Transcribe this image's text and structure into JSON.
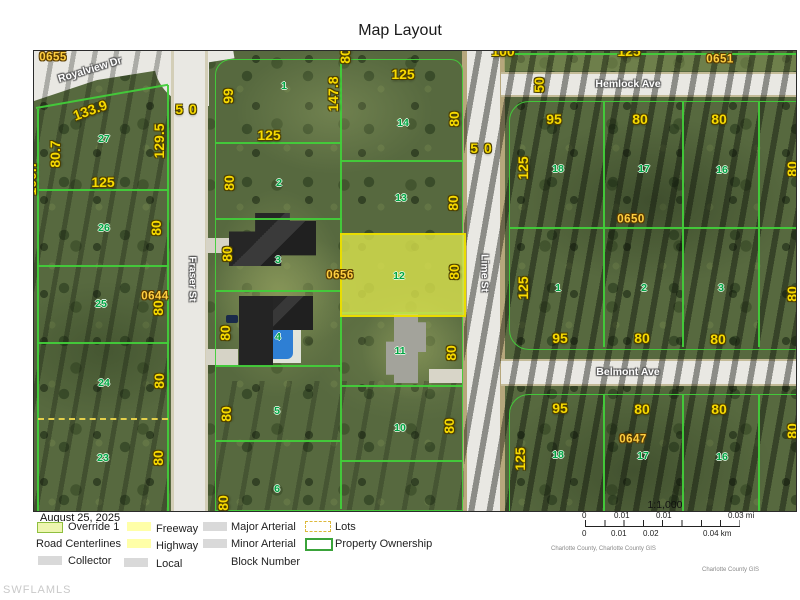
{
  "title": "Map Layout",
  "watermark": "SWFLAMLS",
  "date": "August 25, 2025",
  "colors": {
    "parcel_line_green": "#42ce3a",
    "override_fill_yellow": "#dbe44e",
    "dimension_yellow": "#f8da00",
    "lot_number_green": "#00a445",
    "block_number_yellow": "#ffcf40",
    "street_white": "#e9e8e3"
  },
  "legend": {
    "override": "Override 1",
    "road_centerlines": "Road Centerlines",
    "collector": "Collector",
    "freeway": "Freeway",
    "highway": "Highway",
    "local": "Local",
    "major_arterial": "Major Arterial",
    "minor_arterial": "Minor Arterial",
    "block_number": "Block Number",
    "lots": "Lots",
    "property_ownership": "Property Ownership"
  },
  "scalebar": {
    "ratio": "1:1,000",
    "mi_labels": [
      "0",
      "0.01",
      "0.01",
      "0.03 mi"
    ],
    "km_labels": [
      "0",
      "0.01",
      "0.02",
      "0.04 km"
    ],
    "credit1": "Charlotte County, Charlotte County GIS",
    "credit2": "Charlotte County GIS"
  },
  "map": {
    "streets": [
      "Royalview Dr",
      "Fraser St",
      "Lime St",
      "Hemlock Ave",
      "Belmont Ave"
    ],
    "block_numbers": [
      "0655",
      "0651",
      "0644",
      "0656",
      "0650",
      "0647"
    ],
    "labels": [
      {
        "t": "Royalview Dr",
        "x": 56,
        "y": 19,
        "r": -17,
        "c": "st"
      },
      {
        "t": "Hemlock Ave",
        "x": 594,
        "y": 33,
        "c": "st"
      },
      {
        "t": "Belmont Ave",
        "x": 594,
        "y": 321,
        "c": "st"
      },
      {
        "t": "Fraser St",
        "x": 158,
        "y": 228,
        "r": 90,
        "c": "st"
      },
      {
        "t": "Lime St",
        "x": 450,
        "y": 222,
        "r": 90,
        "c": "st"
      },
      {
        "t": "0655",
        "x": 19,
        "y": 7,
        "c": "blk"
      },
      {
        "t": "0651",
        "x": 686,
        "y": 9,
        "c": "blk"
      },
      {
        "t": "0644",
        "x": 121,
        "y": 246,
        "c": "blk"
      },
      {
        "t": "0656",
        "x": 306,
        "y": 225,
        "c": "blk"
      },
      {
        "t": "0650",
        "x": 597,
        "y": 169,
        "c": "blk"
      },
      {
        "t": "0647",
        "x": 599,
        "y": 389,
        "c": "blk"
      },
      {
        "t": "27",
        "x": 70,
        "y": 88,
        "c": "lot"
      },
      {
        "t": "26",
        "x": 70,
        "y": 177,
        "c": "lot"
      },
      {
        "t": "25",
        "x": 67,
        "y": 253,
        "c": "lot"
      },
      {
        "t": "24",
        "x": 70,
        "y": 332,
        "c": "lot"
      },
      {
        "t": "23",
        "x": 69,
        "y": 407,
        "c": "lot"
      },
      {
        "t": "1",
        "x": 250,
        "y": 35,
        "c": "lot"
      },
      {
        "t": "2",
        "x": 245,
        "y": 132,
        "c": "lot"
      },
      {
        "t": "3",
        "x": 244,
        "y": 209,
        "c": "lot"
      },
      {
        "t": "4",
        "x": 244,
        "y": 286,
        "c": "lot"
      },
      {
        "t": "5",
        "x": 243,
        "y": 360,
        "c": "lot"
      },
      {
        "t": "6",
        "x": 243,
        "y": 438,
        "c": "lot"
      },
      {
        "t": "14",
        "x": 369,
        "y": 72,
        "c": "lot"
      },
      {
        "t": "13",
        "x": 367,
        "y": 147,
        "c": "lot"
      },
      {
        "t": "12",
        "x": 365,
        "y": 225,
        "c": "lot"
      },
      {
        "t": "11",
        "x": 366,
        "y": 300,
        "c": "lot"
      },
      {
        "t": "10",
        "x": 366,
        "y": 377,
        "c": "lot"
      },
      {
        "t": "18",
        "x": 524,
        "y": 118,
        "c": "lot"
      },
      {
        "t": "17",
        "x": 610,
        "y": 118,
        "c": "lot"
      },
      {
        "t": "16",
        "x": 688,
        "y": 119,
        "c": "lot"
      },
      {
        "t": "1",
        "x": 524,
        "y": 237,
        "c": "lot"
      },
      {
        "t": "2",
        "x": 610,
        "y": 237,
        "c": "lot"
      },
      {
        "t": "3",
        "x": 687,
        "y": 237,
        "c": "lot"
      },
      {
        "t": "18",
        "x": 524,
        "y": 404,
        "c": "lot"
      },
      {
        "t": "17",
        "x": 609,
        "y": 405,
        "c": "lot"
      },
      {
        "t": "16",
        "x": 688,
        "y": 406,
        "c": "lot"
      },
      {
        "t": "133.9",
        "x": 56,
        "y": 59,
        "r": -20,
        "c": "dim"
      },
      {
        "t": "125",
        "x": 69,
        "y": 131,
        "c": "dim"
      },
      {
        "t": "125",
        "x": 235,
        "y": 84,
        "c": "dim"
      },
      {
        "t": "125",
        "x": 369,
        "y": 23,
        "c": "dim"
      },
      {
        "t": "95",
        "x": 520,
        "y": 68,
        "c": "dim"
      },
      {
        "t": "80",
        "x": 606,
        "y": 68,
        "c": "dim"
      },
      {
        "t": "80",
        "x": 685,
        "y": 68,
        "c": "dim"
      },
      {
        "t": "95",
        "x": 526,
        "y": 287,
        "c": "dim"
      },
      {
        "t": "80",
        "x": 608,
        "y": 287,
        "c": "dim"
      },
      {
        "t": "80",
        "x": 684,
        "y": 288,
        "c": "dim"
      },
      {
        "t": "95",
        "x": 526,
        "y": 357,
        "c": "dim"
      },
      {
        "t": "80",
        "x": 608,
        "y": 358,
        "c": "dim"
      },
      {
        "t": "80",
        "x": 685,
        "y": 358,
        "c": "dim"
      },
      {
        "t": "100",
        "x": 469,
        "y": 0,
        "c": "dim"
      },
      {
        "t": "125",
        "x": 595,
        "y": 0,
        "c": "dim"
      },
      {
        "t": "50",
        "x": 155,
        "y": 58,
        "c": "dim sp"
      },
      {
        "t": "50",
        "x": 450,
        "y": 97,
        "c": "dim sp"
      },
      {
        "t": "80.7",
        "x": 21,
        "y": 103,
        "r": -90,
        "c": "dim"
      },
      {
        "t": "100.7",
        "x": -3,
        "y": 127,
        "r": -90,
        "c": "dim"
      },
      {
        "t": "129.5",
        "x": 125,
        "y": 90,
        "r": -90,
        "c": "dim"
      },
      {
        "t": "80",
        "x": 122,
        "y": 177,
        "r": -90,
        "c": "dim"
      },
      {
        "t": "80",
        "x": 124,
        "y": 257,
        "r": -90,
        "c": "dim"
      },
      {
        "t": "80",
        "x": 125,
        "y": 330,
        "r": -90,
        "c": "dim"
      },
      {
        "t": "80",
        "x": 124,
        "y": 407,
        "r": -90,
        "c": "dim"
      },
      {
        "t": "99",
        "x": 194,
        "y": 45,
        "r": -90,
        "c": "dim"
      },
      {
        "t": "147.8",
        "x": 299,
        "y": 43,
        "r": -90,
        "c": "dim"
      },
      {
        "t": "80",
        "x": 311,
        "y": 5,
        "r": -90,
        "c": "dim"
      },
      {
        "t": "80",
        "x": 195,
        "y": 132,
        "r": -90,
        "c": "dim"
      },
      {
        "t": "80",
        "x": 193,
        "y": 203,
        "r": -90,
        "c": "dim"
      },
      {
        "t": "80",
        "x": 191,
        "y": 282,
        "r": -90,
        "c": "dim"
      },
      {
        "t": "80",
        "x": 192,
        "y": 363,
        "r": -90,
        "c": "dim"
      },
      {
        "t": "80",
        "x": 189,
        "y": 452,
        "r": -90,
        "c": "dim"
      },
      {
        "t": "80",
        "x": 420,
        "y": 68,
        "r": -90,
        "c": "dim"
      },
      {
        "t": "80",
        "x": 419,
        "y": 152,
        "r": -90,
        "c": "dim"
      },
      {
        "t": "80",
        "x": 420,
        "y": 221,
        "r": -90,
        "c": "dim"
      },
      {
        "t": "80",
        "x": 417,
        "y": 302,
        "r": -90,
        "c": "dim"
      },
      {
        "t": "80",
        "x": 415,
        "y": 375,
        "r": -90,
        "c": "dim"
      },
      {
        "t": "50",
        "x": 505,
        "y": 34,
        "r": -90,
        "c": "dim"
      },
      {
        "t": "125",
        "x": 489,
        "y": 117,
        "r": -90,
        "c": "dim"
      },
      {
        "t": "125",
        "x": 489,
        "y": 237,
        "r": -90,
        "c": "dim"
      },
      {
        "t": "125",
        "x": 486,
        "y": 408,
        "r": -90,
        "c": "dim"
      },
      {
        "t": "80",
        "x": 758,
        "y": 118,
        "r": -90,
        "c": "dim"
      },
      {
        "t": "80",
        "x": 758,
        "y": 243,
        "r": -90,
        "c": "dim"
      },
      {
        "t": "80",
        "x": 758,
        "y": 380,
        "r": -90,
        "c": "dim"
      }
    ]
  }
}
